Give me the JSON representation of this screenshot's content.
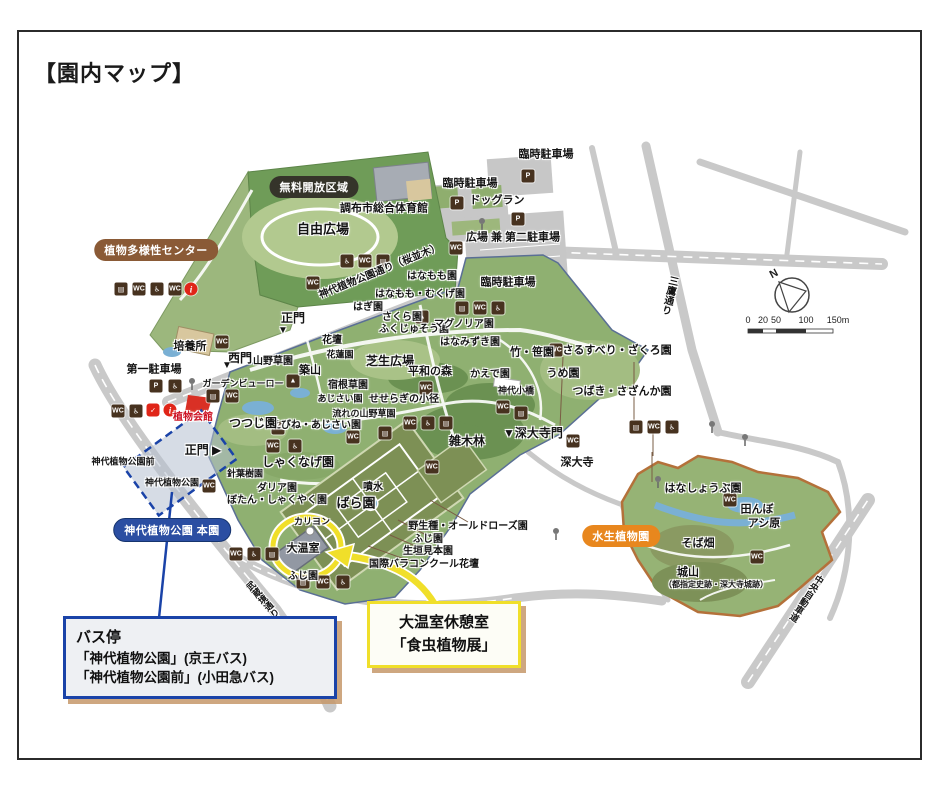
{
  "title": "【園内マップ】",
  "compass": {
    "north_label": "N"
  },
  "scale_bar": {
    "ticks": [
      "0",
      "20",
      "50",
      "100",
      "150m"
    ]
  },
  "badges": [
    {
      "label": "植物多様性センター",
      "x": 156,
      "y": 250,
      "bg": "#8a5a36"
    },
    {
      "label": "無料開放区域",
      "x": 314,
      "y": 187,
      "bg": "#35342a"
    },
    {
      "label": "神代植物公園 本園",
      "x": 172,
      "y": 530,
      "bg": "#2b4ea2"
    },
    {
      "label": "水生植物園",
      "x": 621,
      "y": 536,
      "bg": "#e8871e"
    }
  ],
  "callouts": {
    "bus_stop": {
      "lines": [
        "バス停",
        "「神代植物公園」(京王バス)",
        "「神代植物公園前」(小田急バス)"
      ]
    },
    "greenhouse": {
      "lines": [
        "大温室休憩室",
        "「食虫植物展」"
      ]
    }
  },
  "map": {
    "labels": [
      {
        "t": "臨時駐車場",
        "x": 546,
        "y": 155
      },
      {
        "t": "臨時駐車場",
        "x": 470,
        "y": 184
      },
      {
        "t": "ドッグラン",
        "x": 497,
        "y": 201
      },
      {
        "t": "広場 兼 第二駐車場",
        "x": 513,
        "y": 238
      },
      {
        "t": "臨時駐車場",
        "x": 508,
        "y": 283
      },
      {
        "t": "調布市総合体育館",
        "x": 384,
        "y": 209
      },
      {
        "t": "自由広場",
        "x": 323,
        "y": 229,
        "fs": 13
      },
      {
        "t": "はなもも園",
        "x": 432,
        "y": 277,
        "fs": 10
      },
      {
        "t": "はなもも・むくげ園",
        "x": 420,
        "y": 295,
        "fs": 10
      },
      {
        "t": "はぎ園",
        "x": 368,
        "y": 308,
        "fs": 10
      },
      {
        "t": "さくら園",
        "x": 402,
        "y": 318,
        "fs": 10
      },
      {
        "t": "ふくじゅそう園",
        "x": 414,
        "y": 330,
        "fs": 10
      },
      {
        "t": "マグノリア園",
        "x": 464,
        "y": 325,
        "fs": 10
      },
      {
        "t": "はなみずき園",
        "x": 470,
        "y": 343,
        "fs": 10
      },
      {
        "t": "花壇",
        "x": 332,
        "y": 341,
        "fs": 10
      },
      {
        "t": "花蓮園",
        "x": 340,
        "y": 355,
        "fs": 9
      },
      {
        "t": "芝生広場",
        "x": 390,
        "y": 361,
        "fs": 12
      },
      {
        "t": "平和の森",
        "x": 430,
        "y": 372,
        "fs": 11
      },
      {
        "t": "かえで園",
        "x": 490,
        "y": 375,
        "fs": 10
      },
      {
        "t": "宿根草園",
        "x": 348,
        "y": 386,
        "fs": 10
      },
      {
        "t": "せせらぎの小径",
        "x": 404,
        "y": 400,
        "fs": 10
      },
      {
        "t": "あじさい園",
        "x": 340,
        "y": 399,
        "fs": 9
      },
      {
        "t": "流れの山野草園",
        "x": 364,
        "y": 414,
        "fs": 9
      },
      {
        "t": "えびね・あじさい園",
        "x": 316,
        "y": 426,
        "fs": 10
      },
      {
        "t": "神代小橋",
        "x": 516,
        "y": 391,
        "fs": 9
      },
      {
        "t": "竹・笹園",
        "x": 532,
        "y": 353
      },
      {
        "t": "さるすべり・ざくろ園",
        "x": 617,
        "y": 351
      },
      {
        "t": "うめ園",
        "x": 563,
        "y": 374
      },
      {
        "t": "つばき・さざんか園",
        "x": 622,
        "y": 392
      },
      {
        "t": "▼深大寺門",
        "x": 533,
        "y": 433,
        "fs": 12
      },
      {
        "t": "深大寺",
        "x": 577,
        "y": 463
      },
      {
        "t": "雑木林",
        "x": 467,
        "y": 441,
        "fs": 12
      },
      {
        "t": "正門",
        "x": 293,
        "y": 318,
        "fs": 12
      },
      {
        "t": "▼",
        "x": 283,
        "y": 331,
        "fs": 10
      },
      {
        "t": "西門",
        "x": 240,
        "y": 358,
        "fs": 12
      },
      {
        "t": "▼",
        "x": 227,
        "y": 366,
        "fs": 10
      },
      {
        "t": "培養所",
        "x": 190,
        "y": 347
      },
      {
        "t": "山野草園",
        "x": 273,
        "y": 362,
        "fs": 10
      },
      {
        "t": "築山",
        "x": 310,
        "y": 371
      },
      {
        "t": "第一駐車場",
        "x": 154,
        "y": 370
      },
      {
        "t": "ガーデンビューロー",
        "x": 243,
        "y": 384,
        "fs": 9
      },
      {
        "t": "植物会館",
        "x": 193,
        "y": 418,
        "fs": 10,
        "c": "#cc1122"
      },
      {
        "t": "つつじ園",
        "x": 253,
        "y": 423,
        "fs": 12
      },
      {
        "t": "しゃくなげ園",
        "x": 298,
        "y": 462,
        "fs": 12
      },
      {
        "t": "針葉樹園",
        "x": 245,
        "y": 474,
        "fs": 9
      },
      {
        "t": "ダリア園",
        "x": 277,
        "y": 489,
        "fs": 10
      },
      {
        "t": "ぼたん・しゃくやく園",
        "x": 277,
        "y": 501,
        "fs": 10
      },
      {
        "t": "カリヨン",
        "x": 312,
        "y": 522,
        "fs": 9
      },
      {
        "t": "大温室",
        "x": 303,
        "y": 549
      },
      {
        "t": "ばら園",
        "x": 356,
        "y": 503,
        "fs": 13
      },
      {
        "t": "噴水",
        "x": 373,
        "y": 488,
        "fs": 10
      },
      {
        "t": "野生種・オールドローズ園",
        "x": 468,
        "y": 527,
        "fs": 10
      },
      {
        "t": "ふじ園",
        "x": 428,
        "y": 540,
        "fs": 10
      },
      {
        "t": "生垣見本園",
        "x": 428,
        "y": 552,
        "fs": 10
      },
      {
        "t": "国際バラコンクール花壇",
        "x": 424,
        "y": 565,
        "fs": 10
      },
      {
        "t": "ふじ園",
        "x": 303,
        "y": 577,
        "fs": 10
      },
      {
        "t": "はなしょうぶ園",
        "x": 703,
        "y": 489
      },
      {
        "t": "田んぼ",
        "x": 757,
        "y": 510
      },
      {
        "t": "アシ原",
        "x": 764,
        "y": 524
      },
      {
        "t": "そば畑",
        "x": 698,
        "y": 544
      },
      {
        "t": "城山",
        "x": 688,
        "y": 573
      },
      {
        "t": "（都指定史跡・深大寺城跡）",
        "x": 716,
        "y": 585,
        "fs": 8
      },
      {
        "t": "神代植物公園前",
        "x": 123,
        "y": 462,
        "fs": 9
      },
      {
        "t": "神代植物公園",
        "x": 172,
        "y": 483,
        "fs": 9
      },
      {
        "t": "正門 ▶",
        "x": 203,
        "y": 450,
        "fs": 12
      },
      {
        "t": "神代植物公園通り（桜並木）",
        "x": 380,
        "y": 272,
        "fs": 10,
        "rot": -22
      },
      {
        "t": "三鷹通り",
        "x": 668,
        "y": 295,
        "fs": 10,
        "rot": 13,
        "vert": true
      },
      {
        "t": "武蔵境通り",
        "x": 262,
        "y": 600,
        "fs": 9,
        "rot": -41,
        "vert": true
      },
      {
        "t": "中央自動車道",
        "x": 806,
        "y": 598,
        "fs": 9,
        "rot": 33,
        "vert": true
      }
    ],
    "icons": [
      {
        "n": "vending-machine-icon",
        "g": "▤",
        "x": 121,
        "y": 289
      },
      {
        "n": "toilet-icon",
        "g": "WC",
        "x": 139,
        "y": 289
      },
      {
        "n": "accessible-toilet-icon",
        "g": "♿",
        "x": 157,
        "y": 289
      },
      {
        "n": "toilet-icon",
        "g": "WC",
        "x": 175,
        "y": 289
      },
      {
        "n": "info-icon",
        "g": "i",
        "x": 191,
        "y": 289,
        "k": "redround"
      },
      {
        "n": "parking-icon",
        "g": "P",
        "x": 528,
        "y": 176
      },
      {
        "n": "parking-icon",
        "g": "P",
        "x": 457,
        "y": 203
      },
      {
        "n": "parking-icon",
        "g": "P",
        "x": 518,
        "y": 219
      },
      {
        "n": "toilet-icon",
        "g": "WC",
        "x": 456,
        "y": 248
      },
      {
        "n": "accessible-toilet-icon",
        "g": "♿",
        "x": 347,
        "y": 261
      },
      {
        "n": "toilet-icon",
        "g": "WC",
        "x": 365,
        "y": 261
      },
      {
        "n": "vending-machine-icon",
        "g": "▤",
        "x": 383,
        "y": 261
      },
      {
        "n": "toilet-icon",
        "g": "WC",
        "x": 313,
        "y": 283
      },
      {
        "n": "vending-machine-icon",
        "g": "▤",
        "x": 462,
        "y": 308
      },
      {
        "n": "toilet-icon",
        "g": "WC",
        "x": 480,
        "y": 308
      },
      {
        "n": "accessible-toilet-icon",
        "g": "♿",
        "x": 498,
        "y": 308
      },
      {
        "n": "viewpoint-icon",
        "g": "▲",
        "x": 422,
        "y": 317
      },
      {
        "n": "viewpoint-icon",
        "g": "▲",
        "x": 293,
        "y": 381
      },
      {
        "n": "toilet-icon",
        "g": "WC",
        "x": 556,
        "y": 350
      },
      {
        "n": "toilet-icon",
        "g": "WC",
        "x": 503,
        "y": 407
      },
      {
        "n": "vending-machine-icon",
        "g": "▤",
        "x": 521,
        "y": 413
      },
      {
        "n": "toilet-icon",
        "g": "WC",
        "x": 573,
        "y": 441
      },
      {
        "n": "vending-machine-icon",
        "g": "▤",
        "x": 636,
        "y": 427
      },
      {
        "n": "toilet-icon",
        "g": "WC",
        "x": 654,
        "y": 427
      },
      {
        "n": "accessible-toilet-icon",
        "g": "♿",
        "x": 672,
        "y": 427
      },
      {
        "n": "toilet-icon",
        "g": "WC",
        "x": 410,
        "y": 423
      },
      {
        "n": "accessible-toilet-icon",
        "g": "♿",
        "x": 428,
        "y": 423
      },
      {
        "n": "vending-machine-icon",
        "g": "▤",
        "x": 446,
        "y": 423
      },
      {
        "n": "toilet-icon",
        "g": "WC",
        "x": 353,
        "y": 437
      },
      {
        "n": "vending-machine-icon",
        "g": "▤",
        "x": 385,
        "y": 433
      },
      {
        "n": "toilet-icon",
        "g": "WC",
        "x": 432,
        "y": 467
      },
      {
        "n": "toilet-icon",
        "g": "WC",
        "x": 273,
        "y": 446
      },
      {
        "n": "accessible-toilet-icon",
        "g": "♿",
        "x": 295,
        "y": 446
      },
      {
        "n": "vending-machine-icon",
        "g": "▤",
        "x": 303,
        "y": 582
      },
      {
        "n": "toilet-icon",
        "g": "WC",
        "x": 323,
        "y": 582
      },
      {
        "n": "accessible-toilet-icon",
        "g": "♿",
        "x": 343,
        "y": 582
      },
      {
        "n": "toilet-icon",
        "g": "WC",
        "x": 236,
        "y": 554
      },
      {
        "n": "accessible-toilet-icon",
        "g": "♿",
        "x": 254,
        "y": 554
      },
      {
        "n": "vending-machine-icon",
        "g": "▤",
        "x": 272,
        "y": 554
      },
      {
        "n": "toilet-icon",
        "g": "WC",
        "x": 730,
        "y": 500
      },
      {
        "n": "toilet-icon",
        "g": "WC",
        "x": 757,
        "y": 557
      },
      {
        "n": "vending-machine-icon",
        "g": "▤",
        "x": 213,
        "y": 396
      },
      {
        "n": "toilet-icon",
        "g": "WC",
        "x": 232,
        "y": 396
      },
      {
        "n": "toilet-icon",
        "g": "WC",
        "x": 209,
        "y": 486
      },
      {
        "n": "toilet-icon",
        "g": "WC",
        "x": 118,
        "y": 411
      },
      {
        "n": "accessible-toilet-icon",
        "g": "♿",
        "x": 136,
        "y": 411
      },
      {
        "n": "check-icon",
        "g": "✓",
        "x": 153,
        "y": 410,
        "k": "red"
      },
      {
        "n": "info-icon",
        "g": "i",
        "x": 170,
        "y": 410,
        "k": "redround"
      },
      {
        "n": "parking-icon",
        "g": "P",
        "x": 156,
        "y": 386
      },
      {
        "n": "accessible-parking-icon",
        "g": "♿",
        "x": 175,
        "y": 386
      },
      {
        "n": "toilet-icon",
        "g": "WC",
        "x": 278,
        "y": 428
      },
      {
        "n": "toilet-icon",
        "g": "WC",
        "x": 222,
        "y": 342
      },
      {
        "n": "toilet-icon",
        "g": "WC",
        "x": 426,
        "y": 388
      }
    ]
  }
}
